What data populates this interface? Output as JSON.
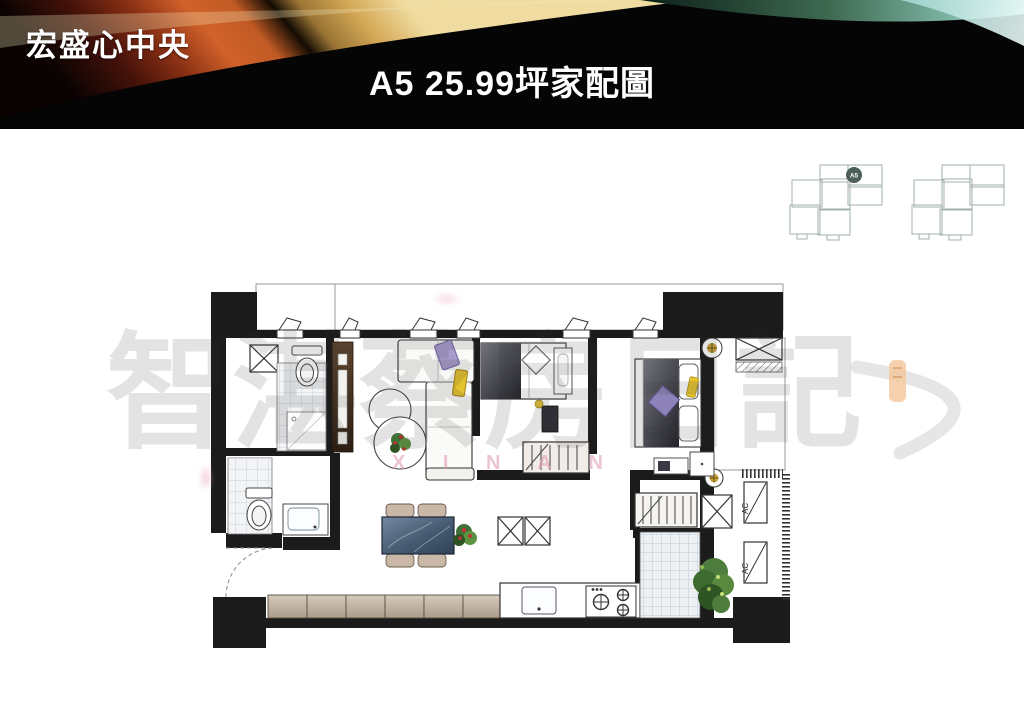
{
  "header": {
    "project_name": "宏盛心中央",
    "title": "A5 25.99坪家配圖",
    "colors": {
      "bar_bg": "#050505",
      "gold": "#d4a856",
      "orange": "#c05a24",
      "dark_red": "#6b1f0e",
      "teal": "#7fb8a8"
    }
  },
  "key_plans": {
    "outline_color": "#a2b0aa",
    "left": {
      "unit_badge": "A5",
      "badge_color": "#4d5f59"
    },
    "right": {}
  },
  "floor_plan": {
    "ac_units": [
      {
        "label": "AC"
      },
      {
        "label": "AC"
      }
    ],
    "wall_color": "#1b1b1b",
    "cabinet_color": "#c9bcae",
    "wood_cabinet_color": "#4b3722",
    "marble_table_color": "#536780",
    "sofa_cushion_yellow": "#e4c32f",
    "pillow_purple": "#8d82ba",
    "duvet_dark": "#3c3c46",
    "plant_green": "#4e7c3c",
    "flower_red": "#c03636",
    "tile_line": "#bfc8d2"
  },
  "watermark": {
    "cjk_chars": [
      "智",
      "湛",
      "蔡",
      "房",
      "日",
      "記"
    ],
    "cjk_text": "智湛蔡房日記",
    "latin_text": "X I N   A N",
    "seal_color": "#f4c69b"
  }
}
